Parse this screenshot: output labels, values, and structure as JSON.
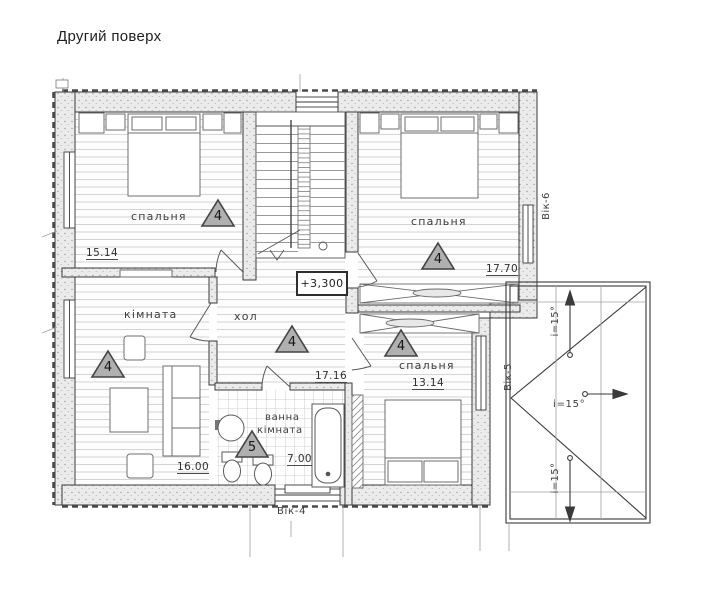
{
  "title": "Другий поверх",
  "elevation_label": "+3,300",
  "rooms": {
    "bedroom_top_left": {
      "name": "спальня",
      "area": "15.14",
      "marker": "4"
    },
    "bedroom_top_right": {
      "name": "спальня",
      "area": "17.70",
      "marker": "4"
    },
    "living_room": {
      "name": "кімната",
      "area": "16.00",
      "marker": "4"
    },
    "hall": {
      "name": "хол",
      "area": "17.16",
      "marker": "4"
    },
    "bathroom": {
      "name_line1": "ванна",
      "name_line2": "кімната",
      "area": "7.00",
      "marker": "5"
    },
    "bedroom_bottom_right": {
      "name": "спальня",
      "area": "13.14",
      "marker": "4"
    }
  },
  "windows": {
    "window_6": "Вік-6",
    "window_5": "Вік-5",
    "window_4": "Вік-4"
  },
  "roof": {
    "slope_top": "і=15°",
    "slope_middle": "і=15°",
    "slope_bottom": "і=15°"
  },
  "colors": {
    "line": "#3a3a3a",
    "wall_fill": "#ebebeb",
    "marker_fill": "#b0b0b0",
    "floor_line": "#d4d4d4",
    "background": "#ffffff"
  }
}
